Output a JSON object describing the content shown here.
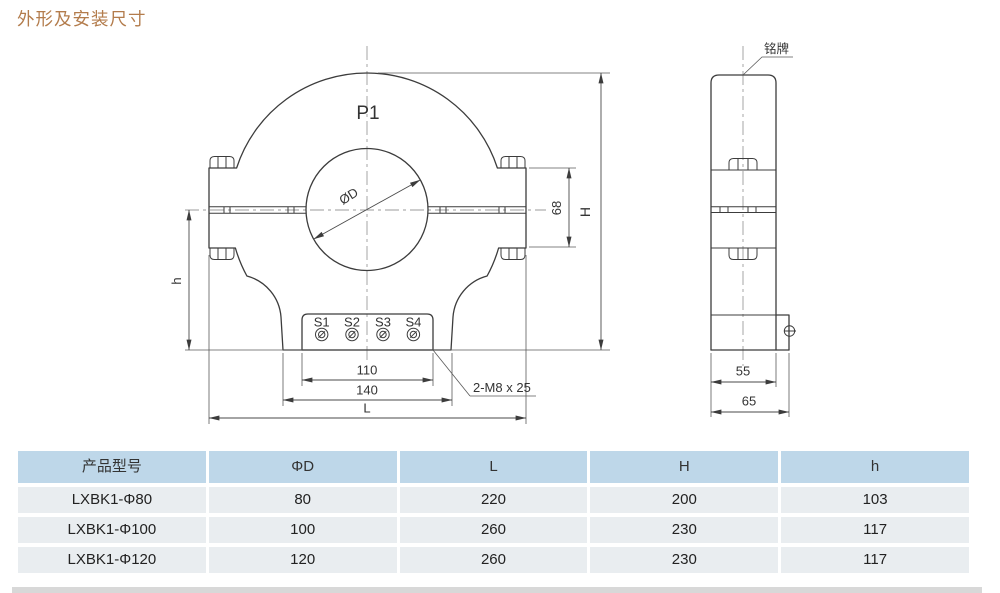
{
  "page": {
    "title": "外形及安装尺寸"
  },
  "drawing": {
    "front_view": {
      "top_label": "P1",
      "aperture_label": "ØD",
      "terminals": [
        "S1",
        "S2",
        "S3",
        "S4"
      ],
      "dims": {
        "terminal_spacing": "110",
        "foot_width": "140",
        "overall_length": "L",
        "overall_height": "H",
        "lower_height": "h",
        "window_height": "68",
        "mounting_bolt": "2-M8 x 25"
      }
    },
    "side_view": {
      "nameplate_label": "铭牌",
      "dims": {
        "body_depth": "55",
        "overall_depth": "65"
      }
    }
  },
  "table": {
    "headers": [
      "产品型号",
      "ΦD",
      "L",
      "H",
      "h"
    ],
    "rows": [
      [
        "LXBK1-Φ80",
        "80",
        "220",
        "200",
        "103"
      ],
      [
        "LXBK1-Φ100",
        "100",
        "260",
        "230",
        "117"
      ],
      [
        "LXBK1-Φ120",
        "120",
        "260",
        "230",
        "117"
      ]
    ]
  }
}
